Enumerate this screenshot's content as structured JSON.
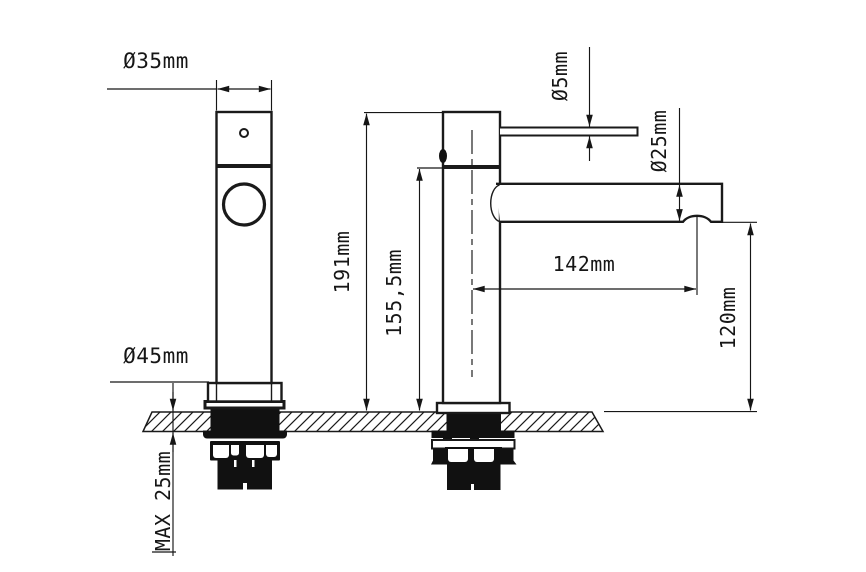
{
  "drawing": {
    "title": "basin-mixer-tap-dimension-drawing",
    "labels": {
      "top_diameter": "Ø35mm",
      "base_diameter": "Ø45mm",
      "total_height": "191mm",
      "body_height": "155,5mm",
      "lever_diameter": "Ø5mm",
      "spout_diameter": "Ø25mm",
      "spout_reach": "142mm",
      "spout_height": "120mm",
      "max_deck_thickness": "MAX 25mm"
    },
    "colors": {
      "line": "#1a1a1a",
      "background": "#ffffff"
    }
  }
}
